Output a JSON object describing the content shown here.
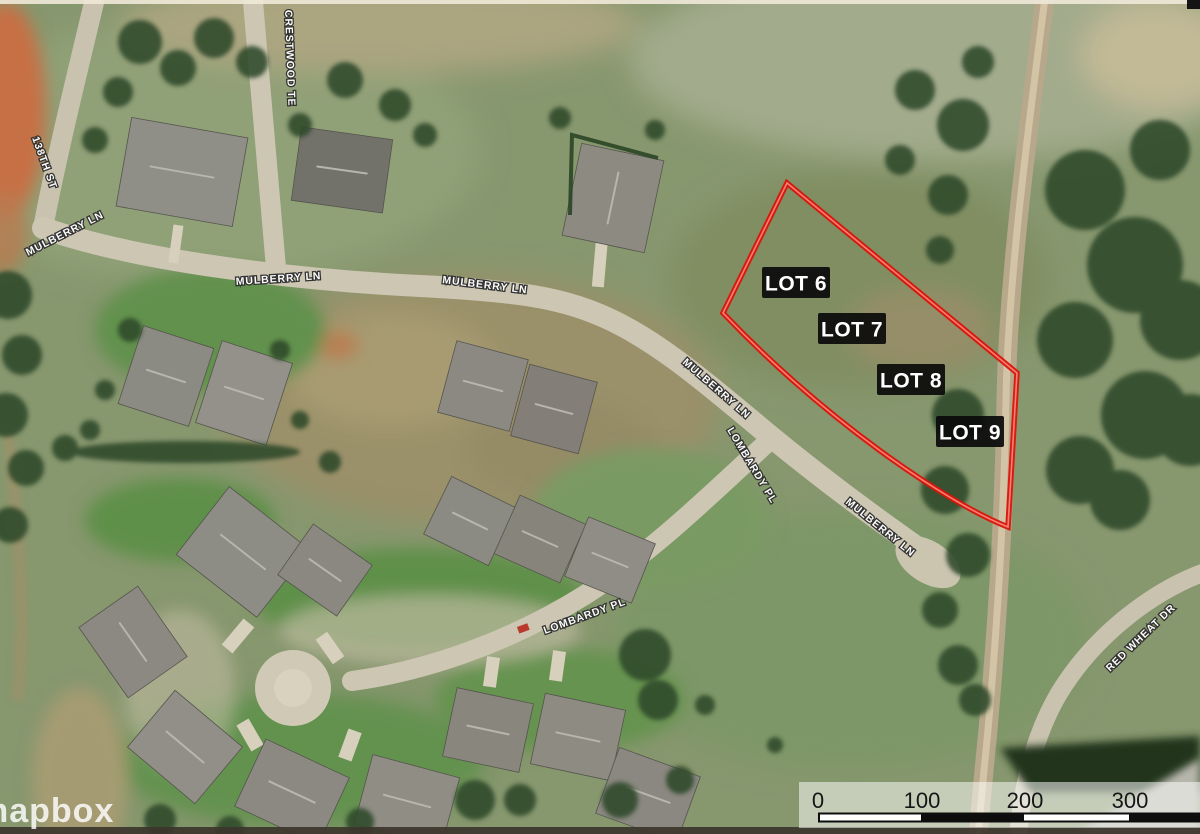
{
  "watermark": {
    "text": "mapbox"
  },
  "lots": {
    "labels": [
      "LOT 6",
      "LOT 7",
      "LOT 8",
      "LOT 9"
    ]
  },
  "streets": {
    "crestwood": "CRESTWOOD TE",
    "street_138": "138TH ST",
    "mulberry": "MULBERRY LN",
    "lombardy": "LOMBARDY PL",
    "red_wheat": "RED WHEAT DR"
  },
  "scale_bar": {
    "ticks": [
      "0",
      "100",
      "200",
      "300"
    ]
  },
  "colors": {
    "lot_boundary": "#d8150b",
    "lot_label_bg": "#0a0a0a",
    "lot_label_text": "#ffffff",
    "street_label_text": "#ffffff",
    "field_green": "#87976e",
    "road": "#ccc6b3"
  }
}
